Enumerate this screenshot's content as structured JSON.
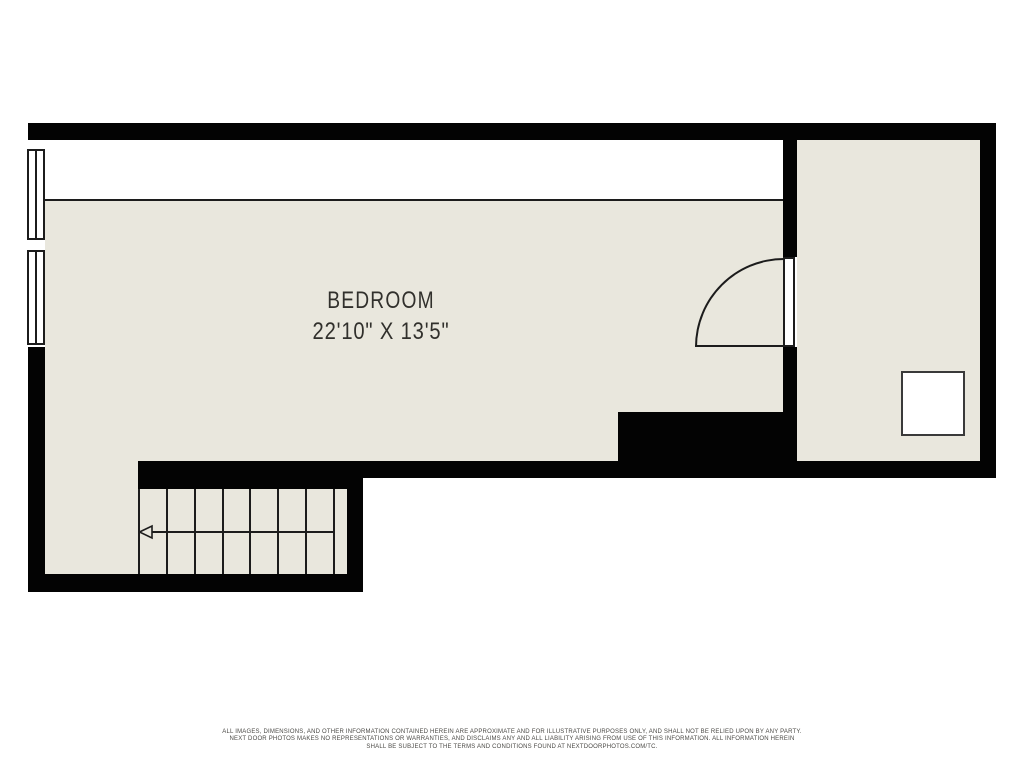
{
  "colors": {
    "background": "#ffffff",
    "wall": "#030303",
    "floor": "#e9e7dd",
    "line": "#1c1c1c",
    "fixture-border": "#3a3a3a",
    "label-text": "#31302c",
    "disclaimer-text": "#4b4a46"
  },
  "floor_plan": {
    "room_label": "BEDROOM",
    "room_dimensions": "22'10\" X 13'5\"",
    "stairs_riser_lines": 8,
    "stairs_arrow_direction": "left",
    "window_count": 2
  },
  "disclaimer": {
    "line1": "ALL IMAGES, DIMENSIONS, AND OTHER INFORMATION CONTAINED HEREIN ARE APPROXIMATE AND FOR ILLUSTRATIVE PURPOSES ONLY, AND SHALL NOT BE RELIED UPON BY ANY PARTY.",
    "line2": "NEXT DOOR PHOTOS MAKES NO REPRESENTATIONS OR WARRANTIES, AND DISCLAIMS ANY AND ALL LIABILITY ARISING FROM USE OF THIS INFORMATION. ALL INFORMATION HEREIN",
    "line3": "SHALL BE SUBJECT TO THE TERMS AND CONDITIONS FOUND AT NEXTDOORPHOTOS.COM/TC."
  }
}
